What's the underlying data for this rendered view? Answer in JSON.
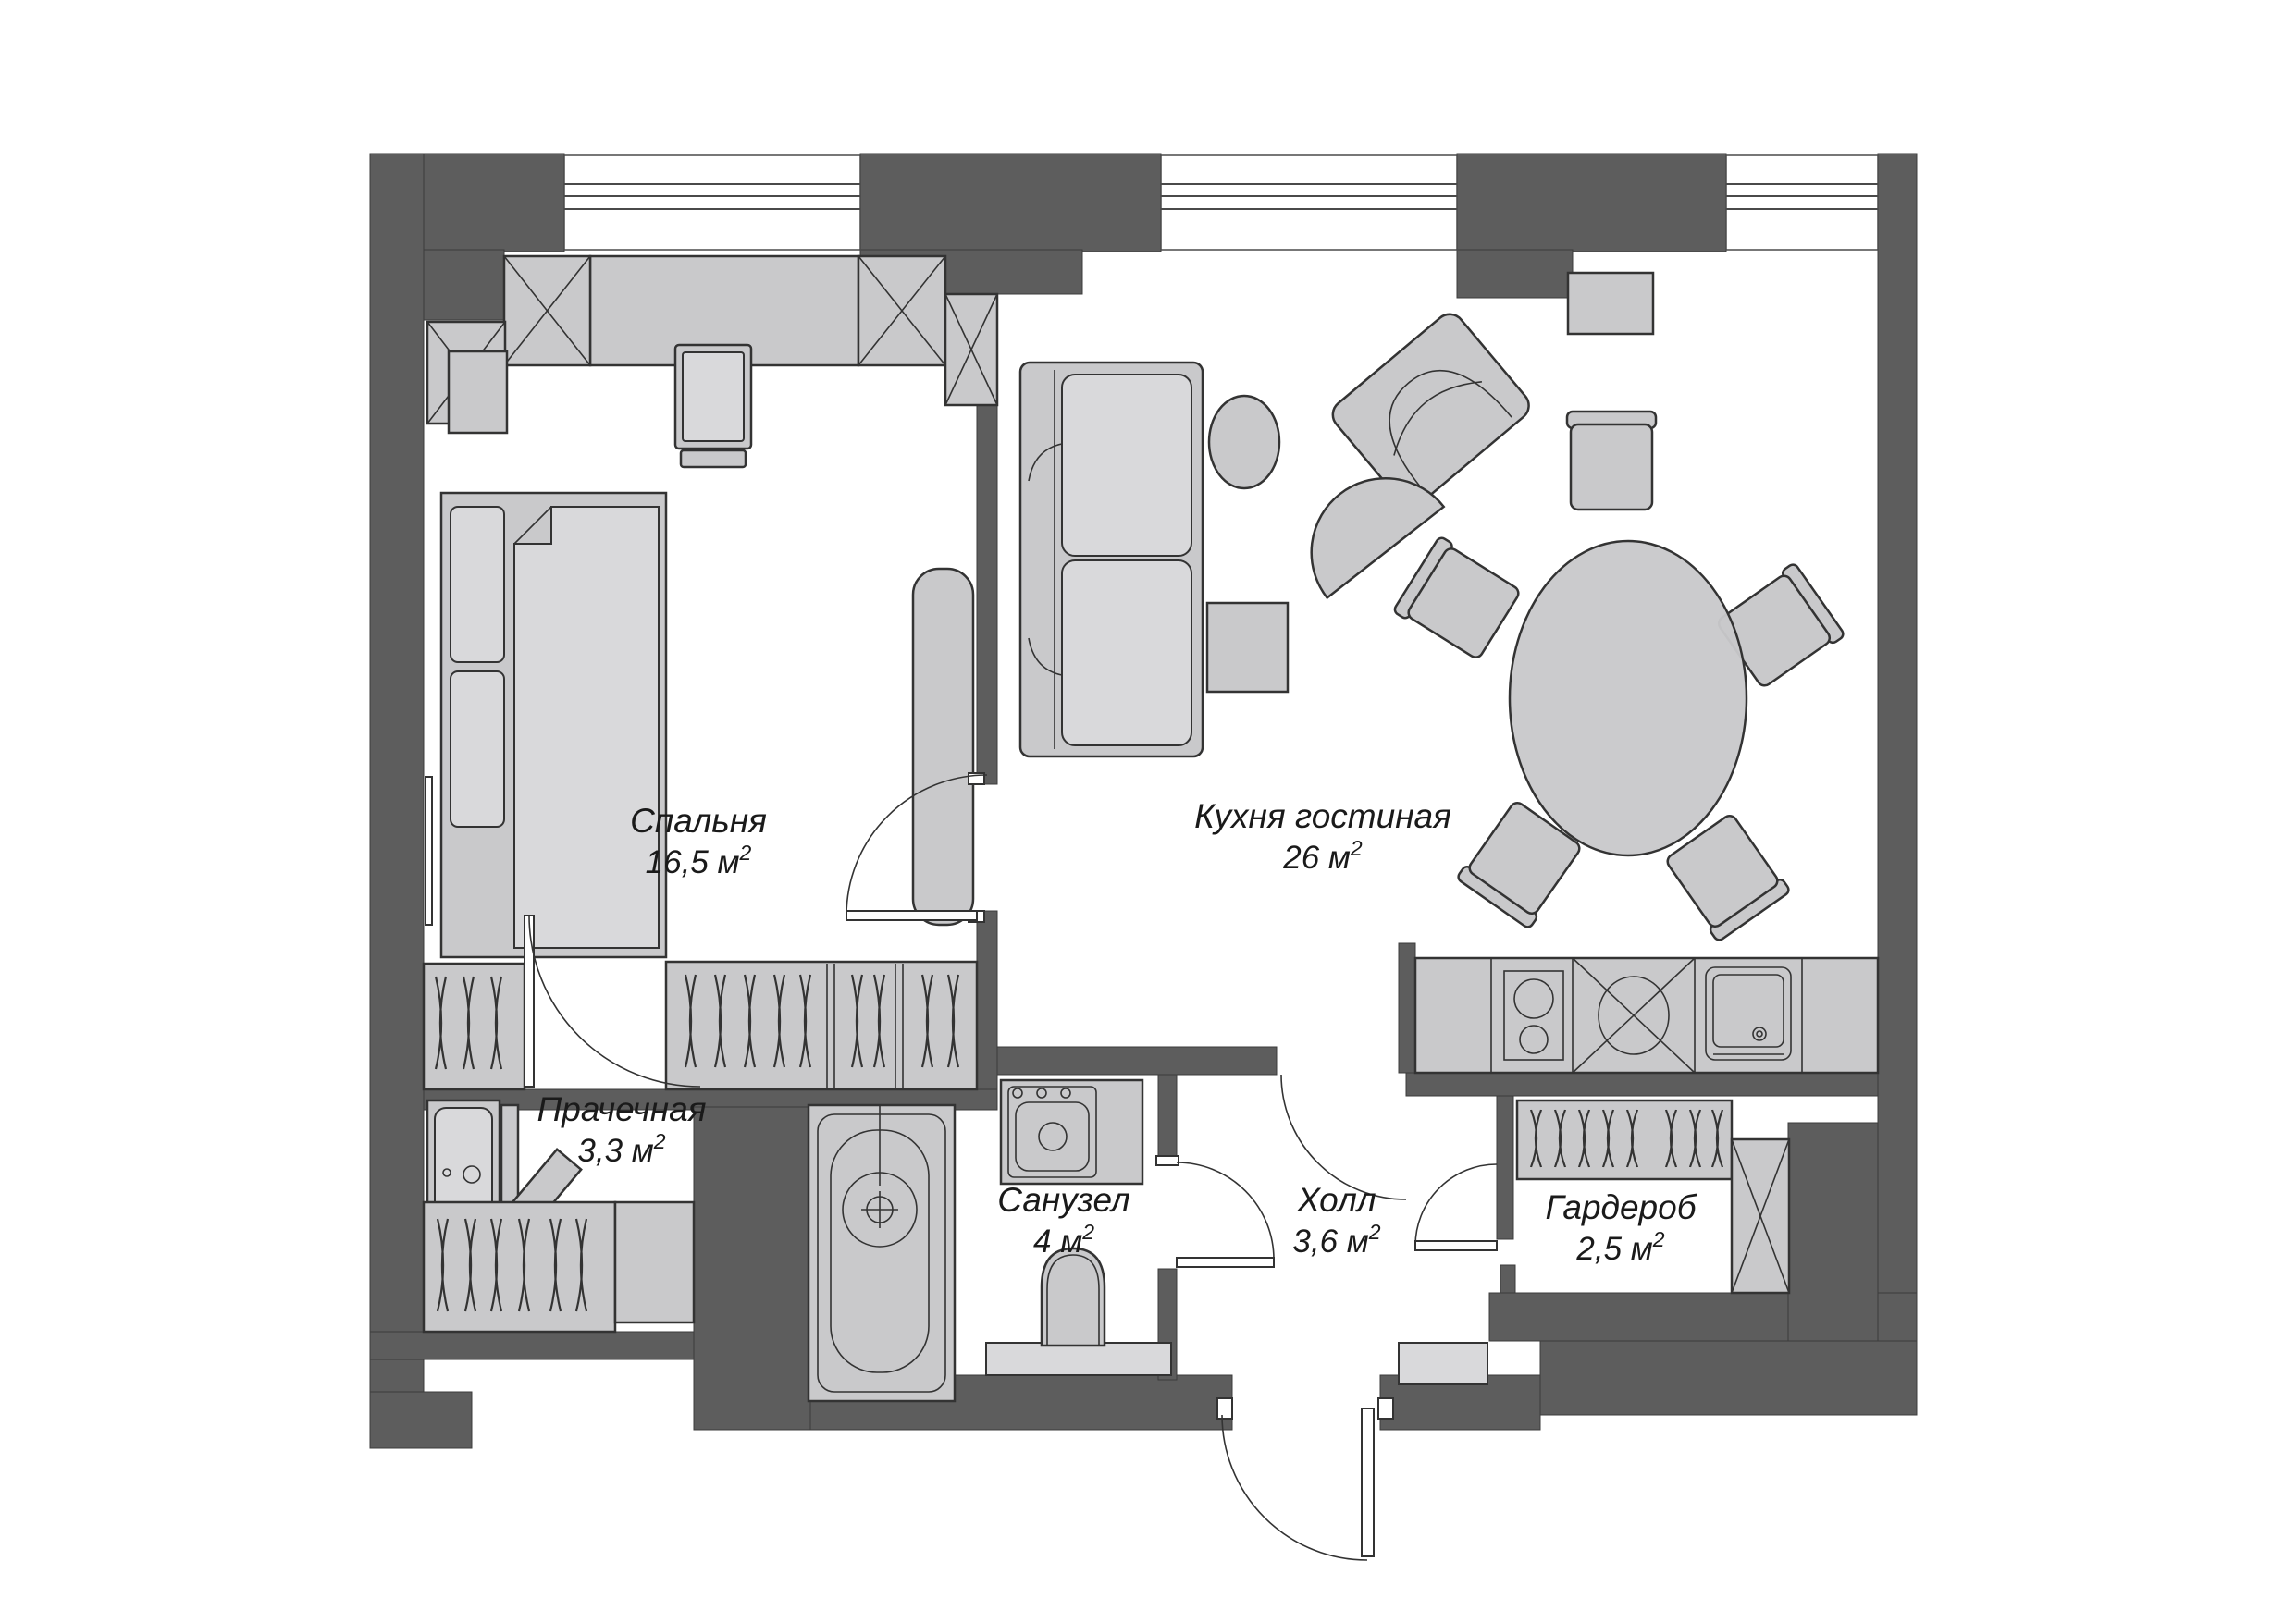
{
  "title": "Apartment floor plan",
  "colors": {
    "wall": "#5d5d5d",
    "furniture": "#c9c9cb",
    "furniture_light": "#d9d9db",
    "outline": "#333333",
    "text": "#1a1a1a",
    "background": "#ffffff",
    "window_line": "#4a4a4a"
  },
  "rooms": {
    "bedroom": {
      "name": "Спальня",
      "area": "16,5 м",
      "sup": "2"
    },
    "kitchen_living": {
      "name": "Кухня гостиная",
      "area": "26 м",
      "sup": "2"
    },
    "laundry": {
      "name": "Прачечная",
      "area": "3,3 м",
      "sup": "2"
    },
    "bathroom": {
      "name": "Санузел",
      "area": "4 м",
      "sup": "2"
    },
    "hall": {
      "name": "Холл",
      "area": "3,6 м",
      "sup": "2"
    },
    "wardrobe": {
      "name": "Гардероб",
      "area": "2,5 м",
      "sup": "2"
    }
  }
}
